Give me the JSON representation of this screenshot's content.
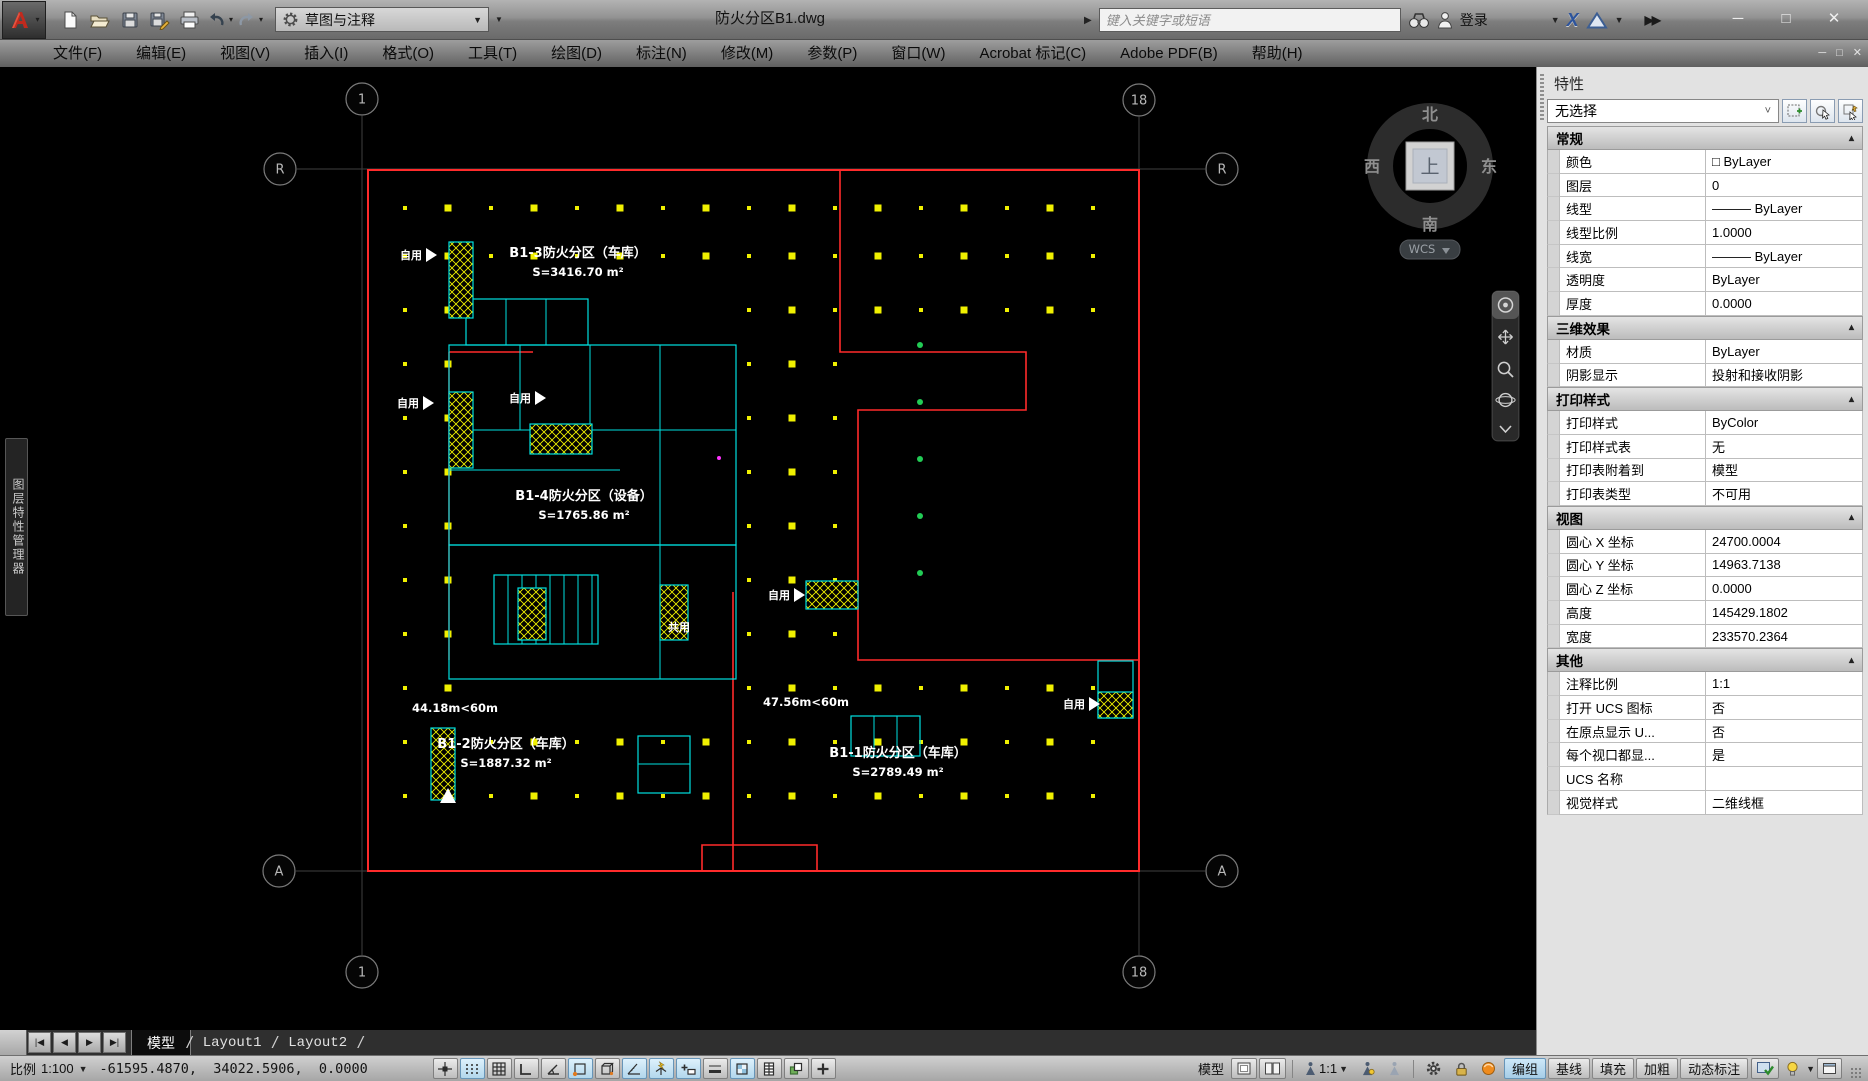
{
  "window": {
    "title": "防火分区B1.dwg"
  },
  "qat": {
    "workspace": "草图与注释",
    "icons": [
      "app-logo",
      "new-file",
      "open-file",
      "save",
      "save-as",
      "plot",
      "undo",
      "redo",
      "workspace-gear",
      "customize-caret"
    ]
  },
  "infocenter": {
    "search_placeholder": "键入关键字或短语",
    "signin_label": "登录",
    "icons": [
      "collapse-arrow",
      "search-binoculars",
      "user",
      "exchange-x",
      "a360",
      "overflow"
    ]
  },
  "menubar": {
    "items": [
      "文件(F)",
      "编辑(E)",
      "视图(V)",
      "插入(I)",
      "格式(O)",
      "工具(T)",
      "绘图(D)",
      "标注(N)",
      "修改(M)",
      "参数(P)",
      "窗口(W)",
      "Acrobat 标记(C)",
      "Adobe PDF(B)",
      "帮助(H)"
    ]
  },
  "left_palette": {
    "title": "图层特性管理器"
  },
  "drawing": {
    "grid_bubbles": [
      {
        "label": "1",
        "x": 362,
        "y": 99
      },
      {
        "label": "18",
        "x": 1139,
        "y": 100
      },
      {
        "label": "R",
        "x": 280,
        "y": 169
      },
      {
        "label": "R",
        "x": 1222,
        "y": 169
      },
      {
        "label": "A",
        "x": 279,
        "y": 871
      },
      {
        "label": "A",
        "x": 1222,
        "y": 871
      },
      {
        "label": "1",
        "x": 362,
        "y": 972
      },
      {
        "label": "18",
        "x": 1139,
        "y": 972
      }
    ],
    "zones": [
      {
        "name": "B1-3防火分区（车库）",
        "area": "S=3416.70 m²",
        "x": 578,
        "y": 257
      },
      {
        "name": "B1-4防火分区（设备）",
        "area": "S=1765.86 m²",
        "x": 584,
        "y": 500
      },
      {
        "name": "B1-2防火分区（车库）",
        "area": "S=1887.32 m²",
        "x": 506,
        "y": 748
      },
      {
        "name": "B1-1防火分区（车库）",
        "area": "S=2789.49 m²",
        "x": 898,
        "y": 757
      }
    ],
    "distances": [
      {
        "text": "44.18m<60m",
        "x": 455,
        "y": 712
      },
      {
        "text": "47.56m<60m",
        "x": 806,
        "y": 706
      }
    ],
    "use_labels": [
      {
        "text": "自用",
        "x": 400,
        "y": 259,
        "tri": true
      },
      {
        "text": "自用",
        "x": 397,
        "y": 407,
        "tri": true
      },
      {
        "text": "自用",
        "x": 509,
        "y": 402,
        "tri": true
      },
      {
        "text": "自用",
        "x": 768,
        "y": 599,
        "tri": true
      },
      {
        "text": "自用",
        "x": 1063,
        "y": 708,
        "tri": true
      },
      {
        "text": "共用",
        "x": 668,
        "y": 631,
        "tri": false
      }
    ],
    "viewcube": {
      "north": "北",
      "south": "南",
      "west": "西",
      "east": "东",
      "top_face": "上",
      "wcs_label": "WCS"
    },
    "navbar_icons": [
      "navigation-wheel",
      "pan",
      "zoom",
      "orbit",
      "show-motion"
    ]
  },
  "properties_panel": {
    "title": "特性",
    "selector": "无选择",
    "header_buttons": [
      "pickadd-toggle",
      "select-objects",
      "quick-select"
    ],
    "sections": [
      {
        "title": "常规",
        "rows": [
          [
            "颜色",
            "□ ByLayer"
          ],
          [
            "图层",
            "0"
          ],
          [
            "线型",
            "——— ByLayer"
          ],
          [
            "线型比例",
            "1.0000"
          ],
          [
            "线宽",
            "——— ByLayer"
          ],
          [
            "透明度",
            "ByLayer"
          ],
          [
            "厚度",
            "0.0000"
          ]
        ]
      },
      {
        "title": "三维效果",
        "rows": [
          [
            "材质",
            "ByLayer"
          ],
          [
            "阴影显示",
            "投射和接收阴影"
          ]
        ]
      },
      {
        "title": "打印样式",
        "rows": [
          [
            "打印样式",
            "ByColor"
          ],
          [
            "打印样式表",
            "无"
          ],
          [
            "打印表附着到",
            "模型"
          ],
          [
            "打印表类型",
            "不可用"
          ]
        ]
      },
      {
        "title": "视图",
        "rows": [
          [
            "圆心 X 坐标",
            "24700.0004"
          ],
          [
            "圆心 Y 坐标",
            "14963.7138"
          ],
          [
            "圆心 Z 坐标",
            "0.0000"
          ],
          [
            "高度",
            "145429.1802"
          ],
          [
            "宽度",
            "233570.2364"
          ]
        ]
      },
      {
        "title": "其他",
        "rows": [
          [
            "注释比例",
            "1:1"
          ],
          [
            "打开 UCS 图标",
            "否"
          ],
          [
            "在原点显示 U...",
            "否"
          ],
          [
            "每个视口都显...",
            "是"
          ],
          [
            "UCS 名称",
            ""
          ],
          [
            "视觉样式",
            "二维线框"
          ]
        ]
      }
    ]
  },
  "tabbar": {
    "tabs": [
      "模型",
      "Layout1",
      "Layout2"
    ],
    "active_index": 0,
    "nav_icons": [
      "first-tab",
      "previous-tab",
      "next-tab",
      "last-tab"
    ]
  },
  "statusbar": {
    "scale_label": "比例",
    "scale_value": "1:100",
    "coordinates": "-61595.4870,  34022.5906,  0.0000",
    "toggles": [
      {
        "name": "snap-mode",
        "lit": false
      },
      {
        "name": "grid-display-dots",
        "lit": true
      },
      {
        "name": "grid-display",
        "lit": false
      },
      {
        "name": "ortho-mode",
        "lit": false
      },
      {
        "name": "polar-tracking",
        "lit": false
      },
      {
        "name": "object-snap",
        "lit": true
      },
      {
        "name": "3d-object-snap",
        "lit": false
      },
      {
        "name": "object-snap-tracking",
        "lit": true
      },
      {
        "name": "dynamic-ucs",
        "lit": true
      },
      {
        "name": "dynamic-input",
        "lit": true
      },
      {
        "name": "lineweight-display",
        "lit": false
      },
      {
        "name": "transparency",
        "lit": true
      },
      {
        "name": "quick-properties",
        "lit": false
      },
      {
        "name": "selection-cycling",
        "lit": false
      },
      {
        "name": "infer-constraints",
        "lit": false
      }
    ],
    "model_label": "模型",
    "annotation_scale": "1:1",
    "text_toggles": [
      {
        "label": "编组",
        "lit": true
      },
      {
        "label": "基线",
        "lit": false
      },
      {
        "label": "填充",
        "lit": false
      },
      {
        "label": "加粗",
        "lit": false
      },
      {
        "label": "动态标注",
        "lit": false
      }
    ]
  },
  "colors": {
    "cad_red": "#ff2b2b",
    "cad_cyan": "#00e0e0",
    "cad_yellow": "#f0f000",
    "cad_green": "#22cc55",
    "cad_magenta": "#ff33ff",
    "axis_gray": "#3f3f3f",
    "lit_toggle": "#cde8f8"
  }
}
